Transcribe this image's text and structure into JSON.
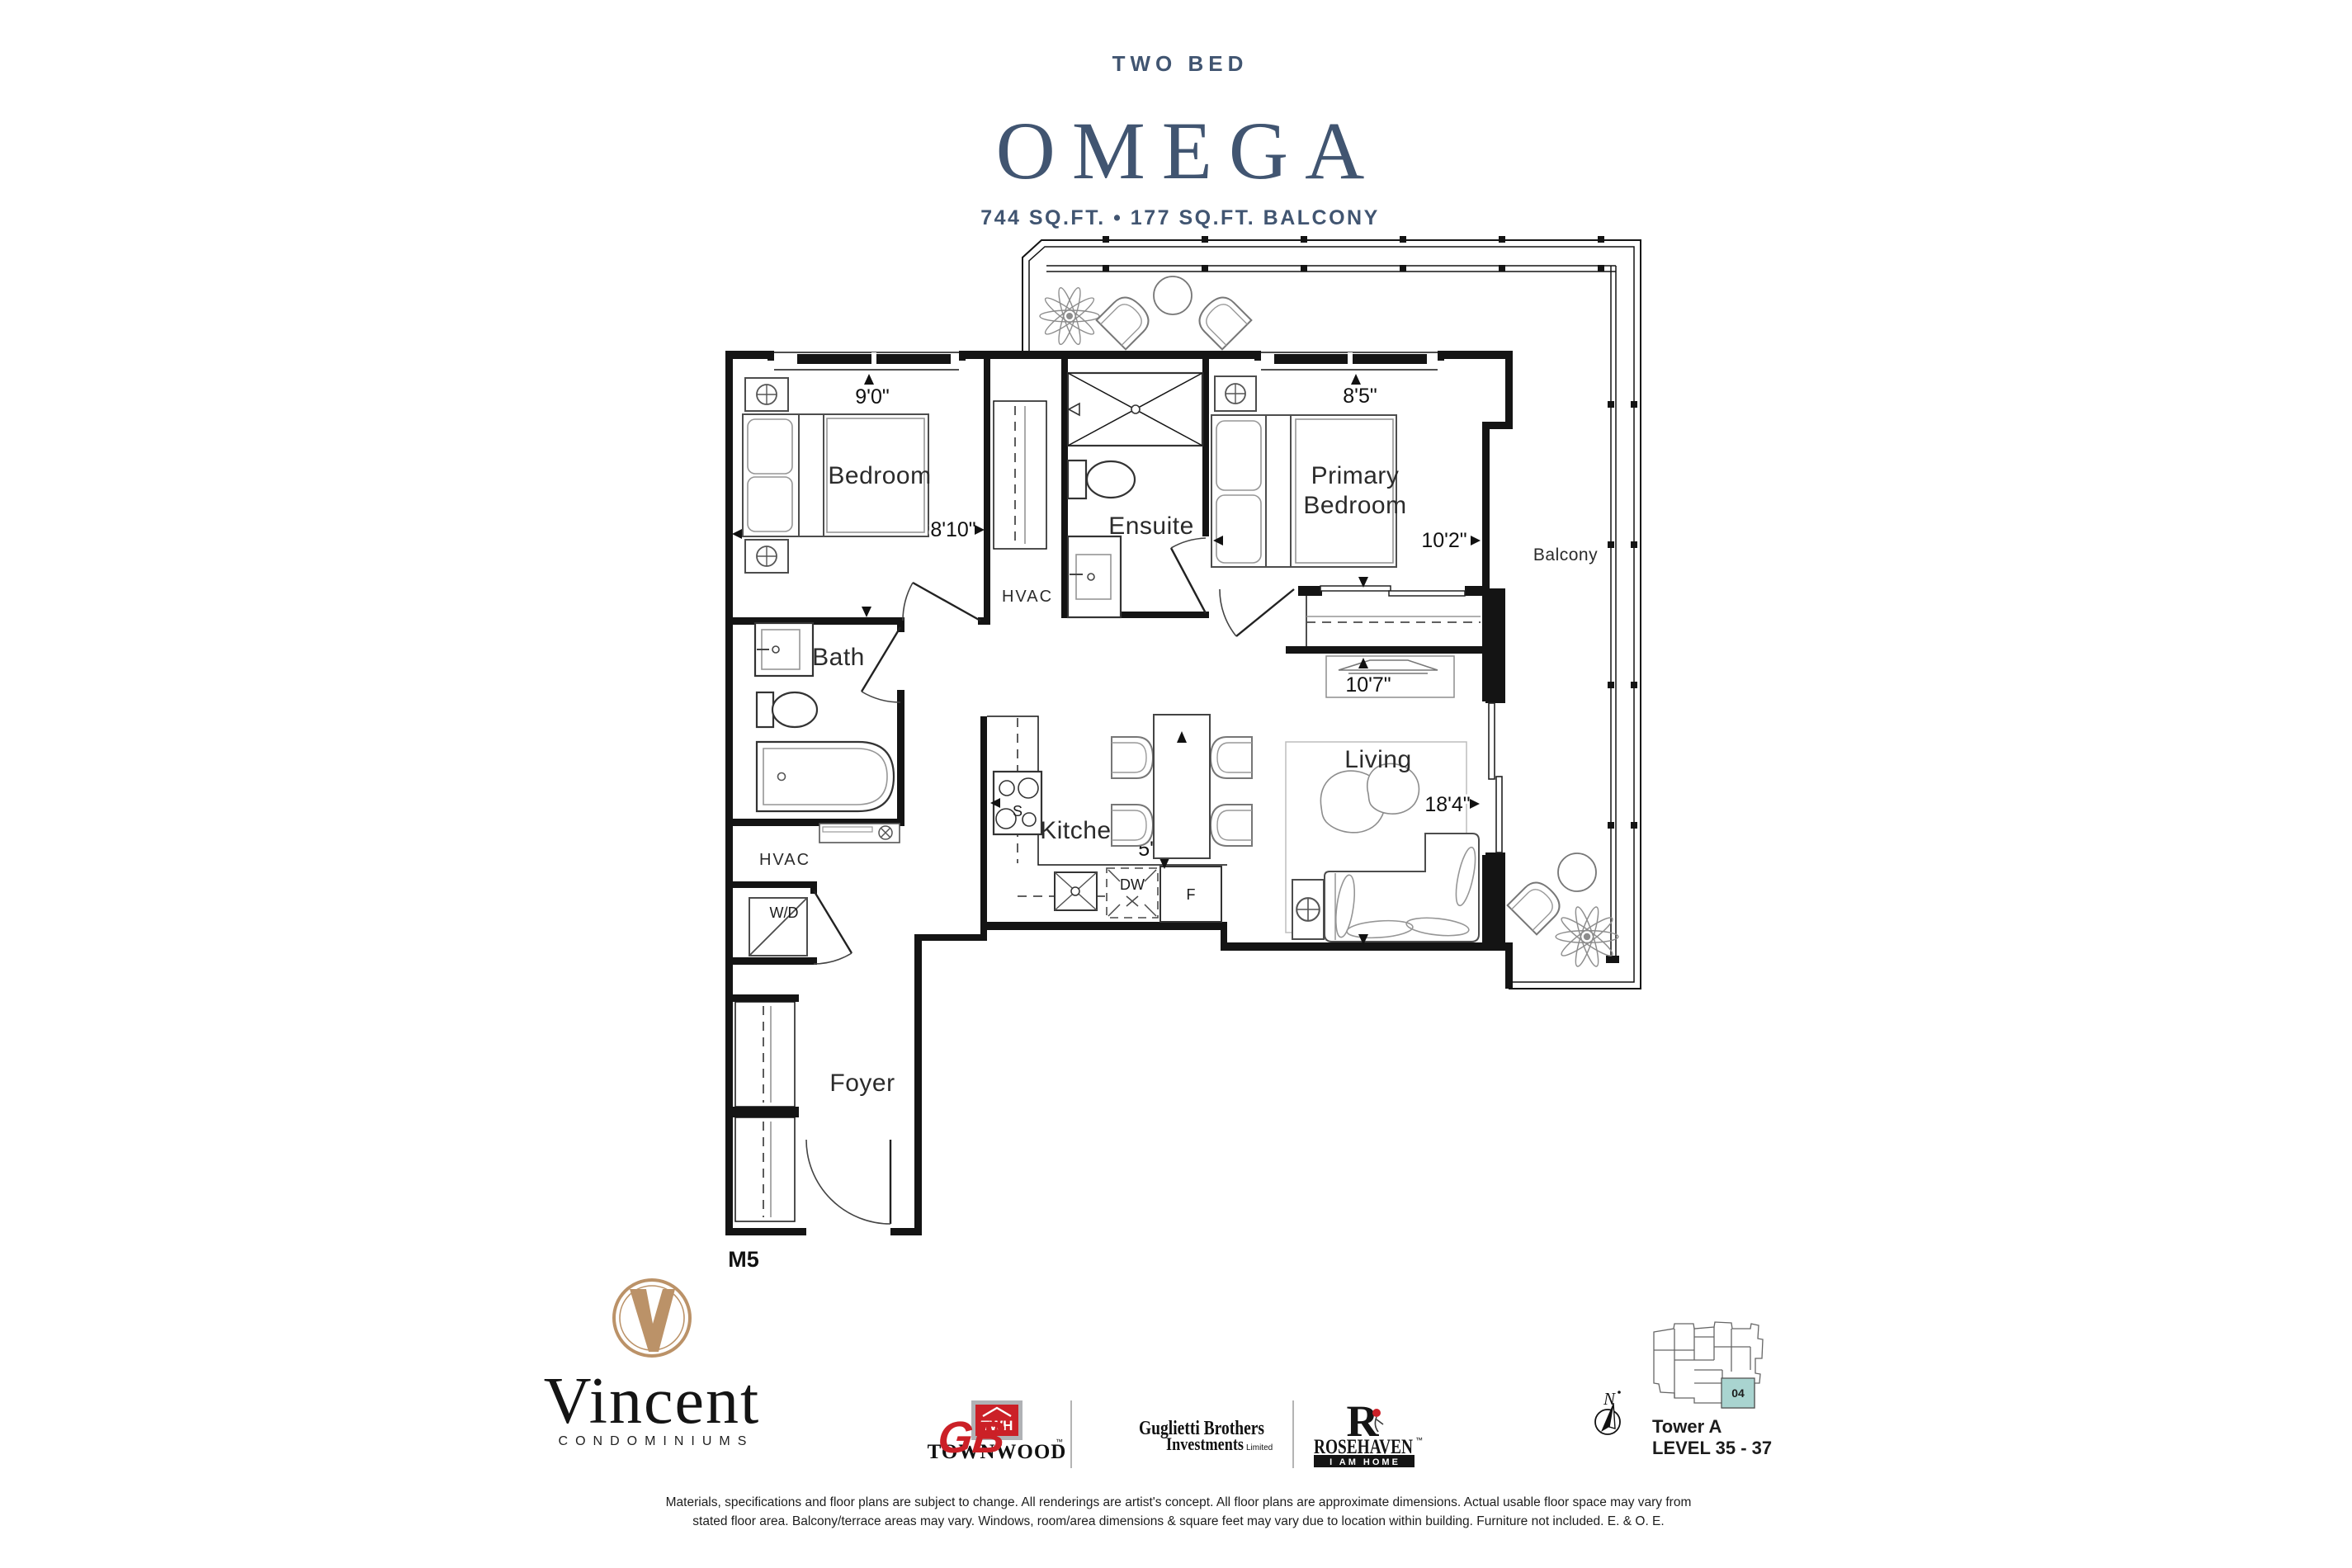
{
  "header": {
    "category": "TWO BED",
    "plan_name": "OMEGA",
    "area_line": "744 SQ.FT. • 177 SQ.FT. BALCONY"
  },
  "plan": {
    "rooms": {
      "bedroom": "Bedroom",
      "ensuite": "Ensuite",
      "primary_line1": "Primary",
      "primary_line2": "Bedroom",
      "bath": "Bath",
      "kitchen": "Kitchen",
      "living": "Living",
      "foyer": "Foyer",
      "balcony": "Balcony"
    },
    "labels": {
      "hvac_upper": "HVAC",
      "hvac_lower": "HVAC",
      "washer_dryer": "W/D",
      "stove": "S",
      "dishwasher": "DW",
      "fridge": "F",
      "unit_model": "M5"
    },
    "dims": {
      "bedroom_width": "9'0\"",
      "bedroom_depth": "8'10\"",
      "primary_width": "8'5\"",
      "primary_depth": "10'2\"",
      "living_width": "10'7\"",
      "living_depth": "18'4\"",
      "kitchen_width": "5'9\""
    }
  },
  "footer": {
    "vincent": {
      "name": "Vincent",
      "subtitle": "CONDOMINIUMS"
    },
    "townwood": {
      "monogram": "TWH",
      "name": "TOWNWOOD",
      "trademark": "™"
    },
    "guglietti": {
      "monogram": "GB",
      "line1": "Guglietti Brothers",
      "line2": "Investments",
      "line3": "Limited"
    },
    "rosehaven": {
      "initial": "R",
      "name": "ROSEHAVEN",
      "trademark": "™",
      "tagline": "I AM HOME"
    },
    "keyplan": {
      "north": "N",
      "unit": "04",
      "tower": "Tower A",
      "level": "LEVEL 35 - 37"
    },
    "disclaimer_line1": "Materials, specifications and floor plans are subject to change. All renderings are artist's concept. All floor plans are approximate dimensions. Actual usable floor space may vary from",
    "disclaimer_line2": "stated floor area. Balcony/terrace areas may vary. Windows, room/area dimensions & square feet may vary due to location within building. Furniture not included. E. & O. E."
  },
  "colors": {
    "accent_navy": "#415571",
    "logo_gold": "#bb9268",
    "brand_red": "#cb2027",
    "unit_teal": "#a9d4d0",
    "line_black": "#141414"
  }
}
